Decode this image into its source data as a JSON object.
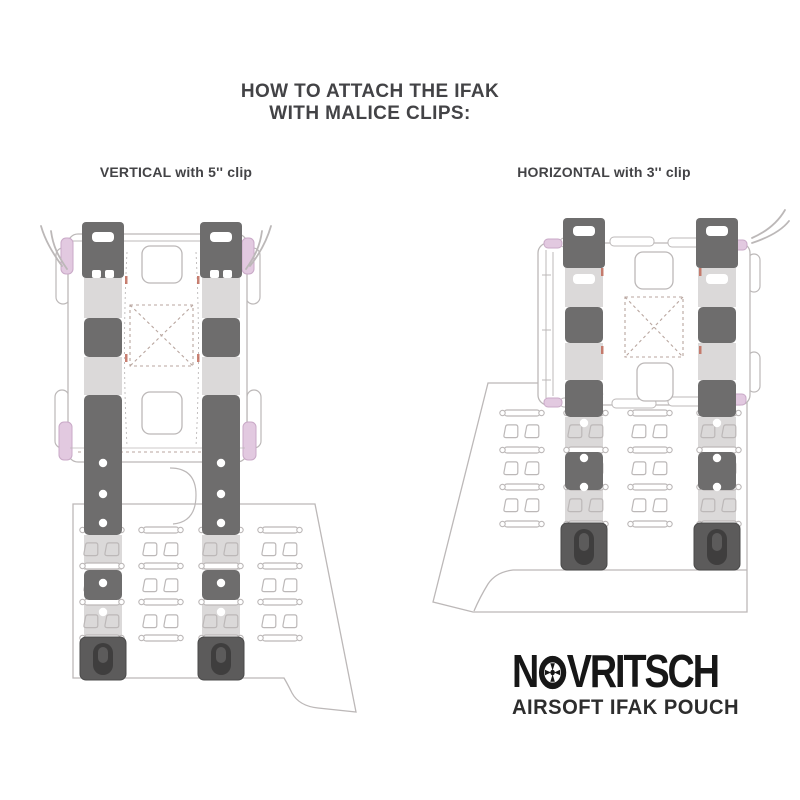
{
  "title": {
    "line1": "HOW TO ATTACH THE IFAK",
    "line2": "WITH MALICE CLIPS:"
  },
  "figures": [
    {
      "id": "vertical",
      "label": "VERTICAL with 5'' clip"
    },
    {
      "id": "horizontal",
      "label": "HORIZONTAL with 3'' clip"
    }
  ],
  "logo": {
    "brand": "NOVRITSCH",
    "brand_prefix": "N",
    "brand_suffix": "VRITSCH",
    "o_icon": "reticle-icon",
    "product": "AIRSOFT IFAK POUCH"
  },
  "colors": {
    "background": "#ffffff",
    "text": "#434346",
    "outline": "#bcb8b8",
    "strap_dark": "#6e6d6d",
    "strap_light": "#dbd9d9",
    "clip_end": "#5c5b5b",
    "clip_buckle": "#3f3e3e",
    "pink_accent": "#e2c9e0",
    "pink_outline": "#c9a9c7",
    "stitch_red": "#c06a5a",
    "dash": "#b9a69f",
    "logo_black": "#171717"
  }
}
